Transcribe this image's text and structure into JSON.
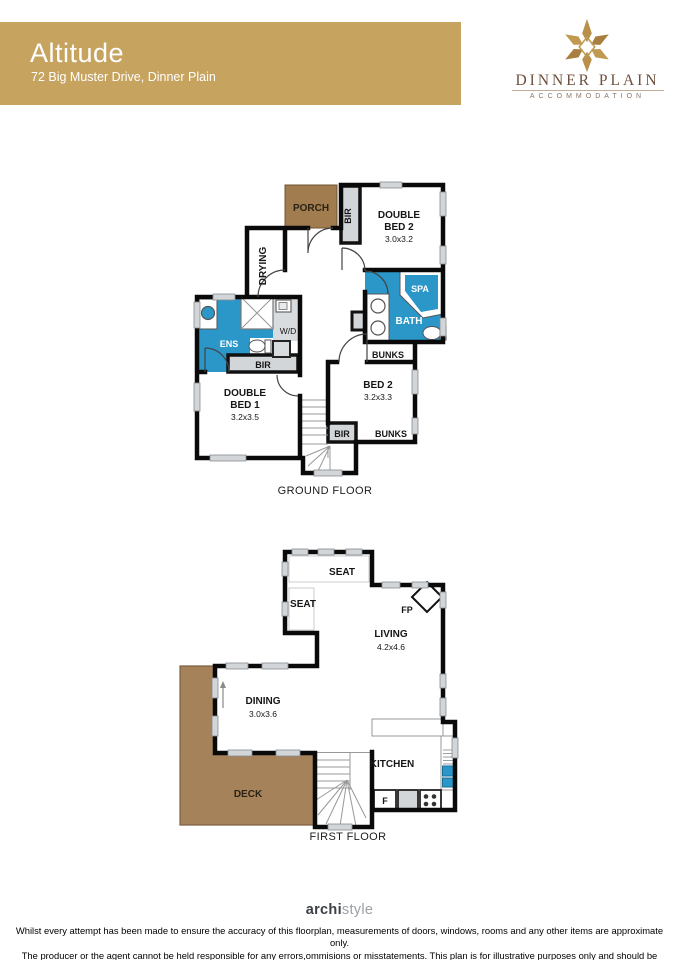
{
  "header": {
    "title": "Altitude",
    "subtitle": "72 Big Muster Drive, Dinner Plain"
  },
  "logo": {
    "brand": "DINNER PLAIN",
    "tagline": "ACCOMMODATION"
  },
  "ground_floor": {
    "caption": "GROUND FLOOR",
    "labels": {
      "porch": "PORCH",
      "bir_bed2": "BIR",
      "double_bed2_l1": "DOUBLE",
      "double_bed2_l2": "BED 2",
      "double_bed2_dim": "3.0x3.2",
      "drying": "DRYING",
      "spa": "SPA",
      "bath": "BATH",
      "bunks_upper": "BUNKS",
      "ens": "ENS",
      "wd": "W/D",
      "bir_ens": "BIR",
      "double_bed1_l1": "DOUBLE",
      "double_bed1_l2": "BED 1",
      "double_bed1_dim": "3.2x3.5",
      "bed2_l1": "BED 2",
      "bed2_dim": "3.2x3.3",
      "bir_stairs": "BIR",
      "bunks_lower": "BUNKS"
    }
  },
  "first_floor": {
    "caption": "FIRST FLOOR",
    "labels": {
      "seat_top": "SEAT",
      "seat_left": "SEAT",
      "fp": "FP",
      "living_l1": "LIVING",
      "living_dim": "4.2x4.6",
      "dining_l1": "DINING",
      "dining_dim": "3.0x3.6",
      "deck": "DECK",
      "kitchen": "KITCHEN",
      "fridge": "F"
    }
  },
  "footer": {
    "brand_bold": "archi",
    "brand_light": "style",
    "disclaimer_line1": "Whilst every attempt has been made to ensure the accuracy of this floorplan, measurements of doors, windows, rooms and any other items are approximate only.",
    "disclaimer_line2": "The producer or the agent cannot be held responsible for any errors,ommisions or misstatements. This plan is for illustrative purposes only and should be used as such."
  },
  "colors": {
    "banner_gold": "#c6a35f",
    "wet_area_blue": "#2b97c9",
    "deck_brown": "#a5825a",
    "porch_brown": "#a17c4e",
    "window_grey": "#d2d6d9",
    "logo_brown": "#6d4e3c"
  }
}
